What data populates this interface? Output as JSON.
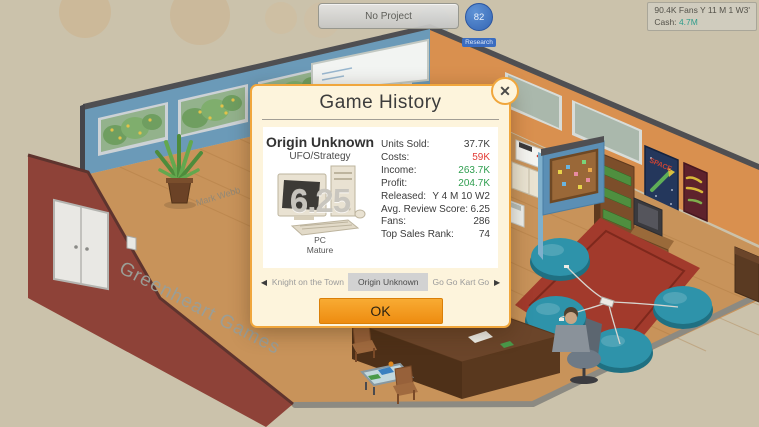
{
  "hud": {
    "no_project_label": "No Project",
    "research_badge": {
      "value": "82",
      "label": "Research"
    },
    "stats_box": {
      "fans_line": "90.4K Fans Y 11 M 1 W3'",
      "cash_label": "Cash:",
      "cash_value": "4.7M"
    }
  },
  "scene": {
    "company_sign": "Greenheart Games",
    "floor_name": "Mark Webb",
    "poster_space_title": "SPACE"
  },
  "dialog": {
    "title": "Game History",
    "close_icon": "✕",
    "game": {
      "name": "Origin Unknown",
      "genre": "UFO/Strategy",
      "score_overlay": "6.25",
      "platform": "PC",
      "rating": "Mature"
    },
    "stats": [
      {
        "label": "Units Sold:",
        "value": "37.7K",
        "color": "default"
      },
      {
        "label": "Costs:",
        "value": "59K",
        "color": "red"
      },
      {
        "label": "Income:",
        "value": "263.7K",
        "color": "green"
      },
      {
        "label": "Profit:",
        "value": "204.7K",
        "color": "green"
      },
      {
        "label": "Released:",
        "value": "Y 4 M 10 W2",
        "color": "default"
      },
      {
        "label": "Avg. Review Score:",
        "value": "6.25",
        "color": "default"
      },
      {
        "label": "Fans:",
        "value": "286",
        "color": "default"
      },
      {
        "label": "Top Sales Rank:",
        "value": "74",
        "color": "default"
      }
    ],
    "nav": {
      "prev_icon": "◀",
      "next_icon": "▶",
      "items": [
        {
          "label": "Knight on the Town",
          "selected": false
        },
        {
          "label": "Origin Unknown",
          "selected": true
        },
        {
          "label": "Go Go Kart Go",
          "selected": false
        }
      ]
    },
    "ok_label": "OK"
  },
  "colors": {
    "dialog_bg": "#fdf4dc",
    "dialog_border": "#f0a63c",
    "ok_orange": "#ee8c10",
    "cost_red": "#e23b35",
    "profit_green": "#2f9e4f",
    "cash_teal": "#2f9d8c",
    "research_blue": "#3a6cc0",
    "wall_blue": "#6b9ab8",
    "wall_orange": "#d9904f",
    "wall_maroon": "#8e4238",
    "floor_wood": "#c8935a",
    "rug_red": "#a23a2c",
    "beanbag_teal": "#2e93aa"
  }
}
